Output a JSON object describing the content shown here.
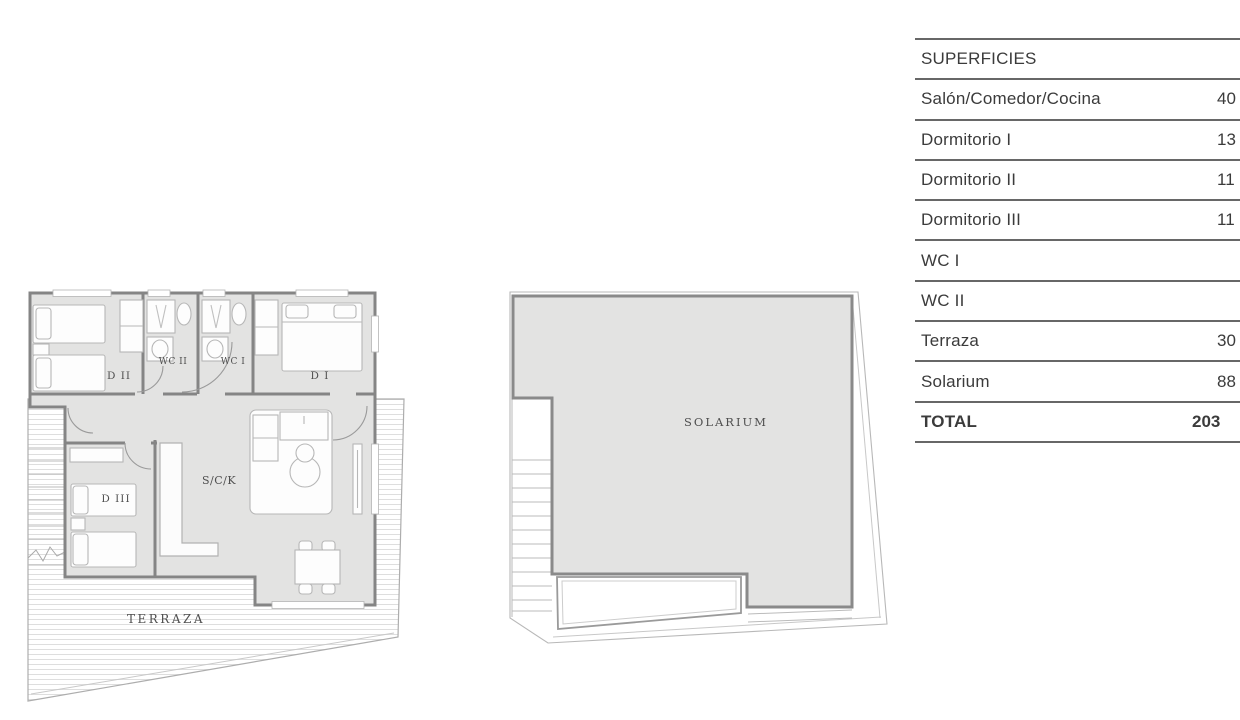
{
  "superficies": {
    "header": "SUPERFICIES",
    "rows": [
      {
        "label": "Salón/Comedor/Cocina",
        "value": "40"
      },
      {
        "label": "Dormitorio I",
        "value": "13"
      },
      {
        "label": "Dormitorio II",
        "value": "11"
      },
      {
        "label": "Dormitorio III",
        "value": "11"
      },
      {
        "label": "WC I",
        "value": ""
      },
      {
        "label": "WC II",
        "value": ""
      },
      {
        "label": "Terraza",
        "value": "30"
      },
      {
        "label": "Solarium",
        "value": "88"
      },
      {
        "label": "TOTAL",
        "value": "203"
      }
    ]
  },
  "floorplan": {
    "labels": {
      "d2": "D II",
      "wc2": "WC II",
      "wc1": "WC I",
      "d1": "D I",
      "d3": "D III",
      "sck": "S/C/K",
      "terraza": "TERRAZA",
      "solarium": "SOLARIUM"
    }
  },
  "colors": {
    "room_fill": "#e3e3e2",
    "wall": "#858585",
    "furniture_line": "#b7b7b7",
    "deck_line": "#dedede",
    "table_line": "#676767",
    "table_text": "#3b3b3b"
  }
}
